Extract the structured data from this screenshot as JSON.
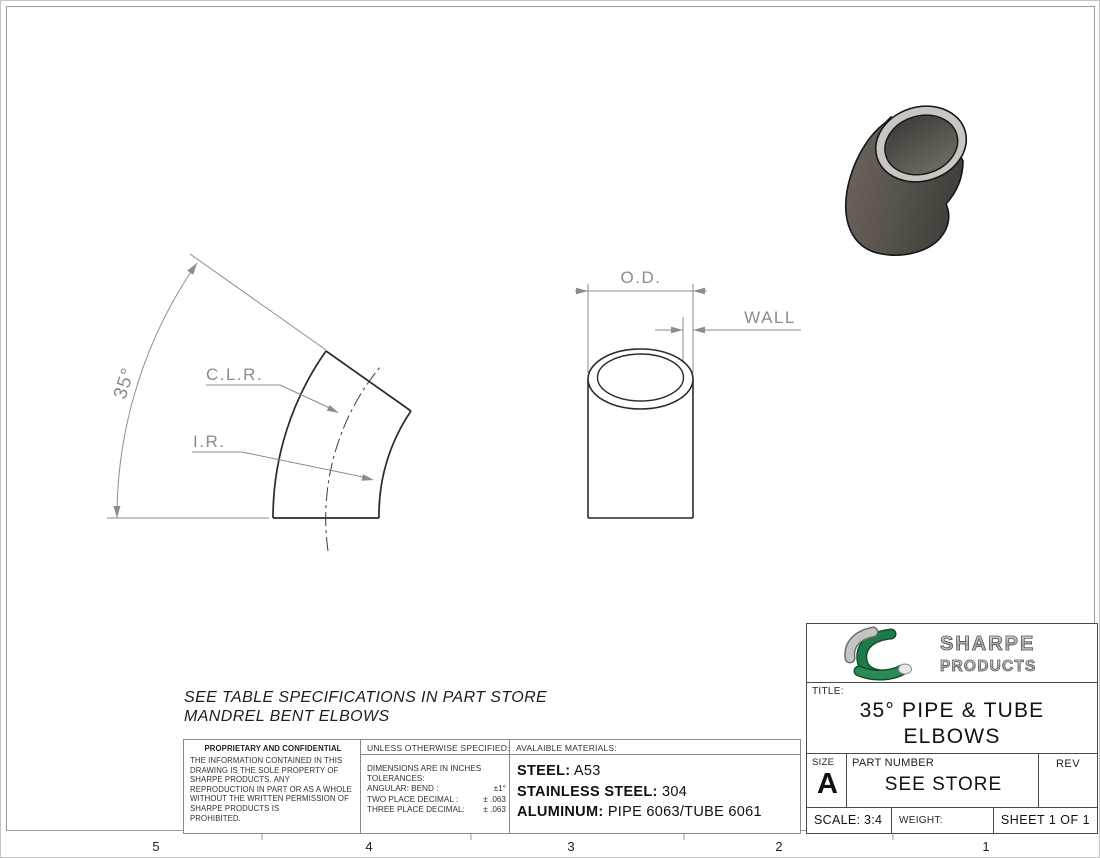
{
  "sheet": {
    "zones": [
      "5",
      "4",
      "3",
      "2",
      "1"
    ],
    "notes": {
      "line1": "SEE TABLE SPECIFICATIONS IN PART STORE",
      "line2": "MANDREL BENT ELBOWS"
    }
  },
  "drawing": {
    "angle": "35°",
    "clr": "C.L.R.",
    "ir": "I.R.",
    "od": "O.D.",
    "wall": "WALL"
  },
  "proprietary": {
    "title": "PROPRIETARY AND CONFIDENTIAL",
    "lines": [
      "THE INFORMATION CONTAINED IN THIS",
      "DRAWING IS THE SOLE PROPERTY OF",
      "SHARPE PRODUCTS.  ANY",
      "REPRODUCTION IN PART OR AS A WHOLE",
      "WITHOUT THE WRITTEN PERMISSION OF",
      "SHARPE PRODUCTS IS",
      "PROHIBITED."
    ]
  },
  "tolerances": {
    "header": "UNLESS OTHERWISE SPECIFIED:",
    "line1": "DIMENSIONS ARE IN INCHES",
    "line2": "TOLERANCES:",
    "rows": [
      {
        "label": "ANGULAR: BEND :",
        "value": "±1°"
      },
      {
        "label": "TWO PLACE DECIMAL  :",
        "value": "± .063"
      },
      {
        "label": "THREE PLACE DECIMAL:",
        "value": "± .063"
      }
    ]
  },
  "materials": {
    "header": "AVALAIBLE MATERIALS:",
    "rows": [
      {
        "label": "STEEL:",
        "value": "A53"
      },
      {
        "label": "STAINLESS STEEL:",
        "value": "304"
      },
      {
        "label": "ALUMINUM:",
        "value": "PIPE 6063/TUBE 6061"
      }
    ]
  },
  "title_block": {
    "brand_top": "SHARPE",
    "brand_bottom": "PRODUCTS",
    "title_label": "TITLE:",
    "title_line1": "35° PIPE & TUBE",
    "title_line2": "ELBOWS",
    "size_label": "SIZE",
    "size_value": "A",
    "part_number_label": "PART NUMBER",
    "part_number_value": "SEE STORE",
    "rev_label": "REV",
    "scale": "SCALE: 3:4",
    "weight": "WEIGHT:",
    "sheet_of": "SHEET 1 OF 1"
  },
  "colors": {
    "line_dark": "#2a2a2a",
    "dim_gray": "#8c8c8c",
    "brand_green": "#1e7a4a",
    "metal_light": "#ededed",
    "metal_dark": "#8f8f8f"
  }
}
